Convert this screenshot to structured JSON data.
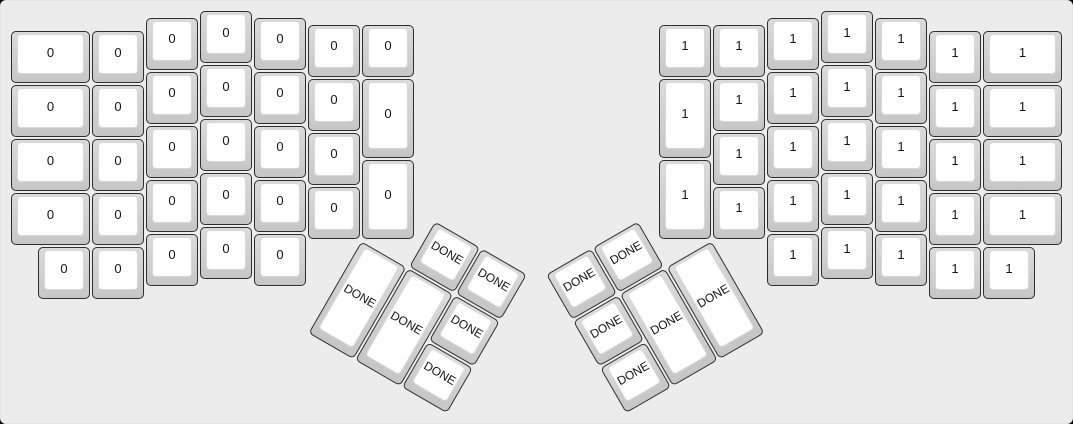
{
  "app": {
    "description": "Split ergonomic keyboard layout (ErgoDox) render with two halves and rotated thumb clusters",
    "visible_text_values": [
      "0",
      "1",
      "DONE"
    ]
  },
  "palette": {
    "page_background": "#000000",
    "canvas_background": "#ececec",
    "canvas_border": "#e3e3e3",
    "key_base_top": "#dbdbdb",
    "key_base_bottom": "#c6c6c6",
    "key_border": "#2e2e2e",
    "cap_fill": "#fefefe",
    "cap_border": "#d8d8d8",
    "legend_color": "#141414"
  },
  "layout": {
    "unit_px": 54,
    "halves": [
      {
        "side": "left",
        "origin": {
          "x": 9,
          "y": 9
        },
        "main_legend": "0",
        "main_keys": [
          [
            0,
            0.375,
            1.5,
            1
          ],
          [
            1.5,
            0.375,
            1,
            1
          ],
          [
            2.5,
            0.125,
            1,
            1
          ],
          [
            3.5,
            0,
            1,
            1
          ],
          [
            4.5,
            0.125,
            1,
            1
          ],
          [
            5.5,
            0.25,
            1,
            1
          ],
          [
            6.5,
            0.25,
            1,
            1
          ],
          [
            0,
            1.375,
            1.5,
            1
          ],
          [
            1.5,
            1.375,
            1,
            1
          ],
          [
            2.5,
            1.125,
            1,
            1
          ],
          [
            3.5,
            1,
            1,
            1
          ],
          [
            4.5,
            1.125,
            1,
            1
          ],
          [
            5.5,
            1.25,
            1,
            1
          ],
          [
            6.5,
            1.25,
            1,
            1.5
          ],
          [
            0,
            2.375,
            1.5,
            1
          ],
          [
            1.5,
            2.375,
            1,
            1
          ],
          [
            2.5,
            2.125,
            1,
            1
          ],
          [
            3.5,
            2,
            1,
            1
          ],
          [
            4.5,
            2.125,
            1,
            1
          ],
          [
            5.5,
            2.25,
            1,
            1
          ],
          [
            6.5,
            2.75,
            1,
            1.5
          ],
          [
            0,
            3.375,
            1.5,
            1
          ],
          [
            1.5,
            3.375,
            1,
            1
          ],
          [
            2.5,
            3.125,
            1,
            1
          ],
          [
            3.5,
            3,
            1,
            1
          ],
          [
            4.5,
            3.125,
            1,
            1
          ],
          [
            5.5,
            3.25,
            1,
            1
          ],
          [
            0.5,
            4.375,
            1,
            1
          ],
          [
            1.5,
            4.375,
            1,
            1
          ],
          [
            2.5,
            4.125,
            1,
            1
          ],
          [
            3.5,
            4,
            1,
            1
          ],
          [
            4.5,
            4.125,
            1,
            1
          ]
        ],
        "thumb": {
          "legend": "DONE",
          "angle_deg": 30,
          "center": {
            "x": 6.5,
            "y": 4.25
          },
          "keys": [
            [
              1,
              -1,
              1,
              1
            ],
            [
              2,
              -1,
              1,
              1
            ],
            [
              0,
              0,
              1,
              2
            ],
            [
              1,
              0,
              1,
              2
            ],
            [
              2,
              0,
              1,
              1
            ],
            [
              2,
              1,
              1,
              1
            ]
          ]
        }
      },
      {
        "side": "right",
        "origin": {
          "x": 657,
          "y": 9
        },
        "main_legend": "1",
        "main_keys": [
          [
            0,
            0.25,
            1,
            1
          ],
          [
            1,
            0.25,
            1,
            1
          ],
          [
            2,
            0.125,
            1,
            1
          ],
          [
            3,
            0,
            1,
            1
          ],
          [
            4,
            0.125,
            1,
            1
          ],
          [
            5,
            0.375,
            1,
            1
          ],
          [
            6,
            0.375,
            1.5,
            1
          ],
          [
            0,
            1.25,
            1,
            1.5
          ],
          [
            1,
            1.25,
            1,
            1
          ],
          [
            2,
            1.125,
            1,
            1
          ],
          [
            3,
            1,
            1,
            1
          ],
          [
            4,
            1.125,
            1,
            1
          ],
          [
            5,
            1.375,
            1,
            1
          ],
          [
            6,
            1.375,
            1.5,
            1
          ],
          [
            0,
            2.75,
            1,
            1.5
          ],
          [
            1,
            2.25,
            1,
            1
          ],
          [
            2,
            2.125,
            1,
            1
          ],
          [
            3,
            2,
            1,
            1
          ],
          [
            4,
            2.125,
            1,
            1
          ],
          [
            5,
            2.375,
            1,
            1
          ],
          [
            6,
            2.375,
            1.5,
            1
          ],
          [
            1,
            3.25,
            1,
            1
          ],
          [
            2,
            3.125,
            1,
            1
          ],
          [
            3,
            3,
            1,
            1
          ],
          [
            4,
            3.125,
            1,
            1
          ],
          [
            5,
            3.375,
            1,
            1
          ],
          [
            6,
            3.375,
            1.5,
            1
          ],
          [
            2,
            4.125,
            1,
            1
          ],
          [
            3,
            4,
            1,
            1
          ],
          [
            4,
            4.125,
            1,
            1
          ],
          [
            5,
            4.375,
            1,
            1
          ],
          [
            6,
            4.375,
            1,
            1
          ]
        ],
        "thumb": {
          "legend": "DONE",
          "angle_deg": -30,
          "center": {
            "x": 1,
            "y": 4.25
          },
          "keys": [
            [
              -3,
              -1,
              1,
              1
            ],
            [
              -2,
              -1,
              1,
              1
            ],
            [
              -3,
              0,
              1,
              1
            ],
            [
              -2,
              0,
              1,
              2
            ],
            [
              -1,
              0,
              1,
              2
            ],
            [
              -3,
              1,
              1,
              1
            ]
          ]
        }
      }
    ]
  }
}
